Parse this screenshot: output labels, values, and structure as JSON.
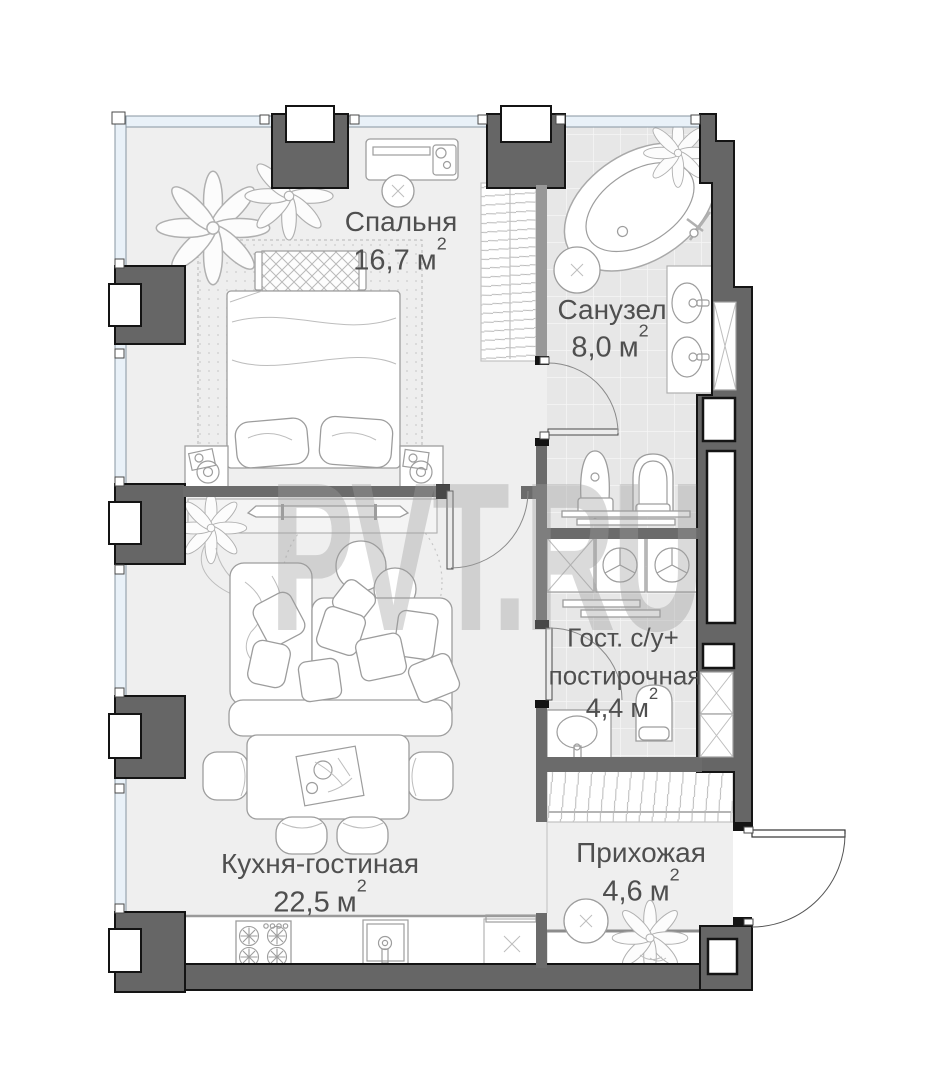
{
  "watermark": {
    "text": "PVT.RU"
  },
  "units": {
    "symbol": "м",
    "sup": "2"
  },
  "rooms": {
    "bedroom": {
      "name": "Спальня",
      "area": "16,7"
    },
    "bathroom": {
      "name": "Санузел",
      "area": "8,0"
    },
    "guest_wc": {
      "name_line1": "Гост. с/у+",
      "name_line2": "постирочная",
      "area": "4,4"
    },
    "kitchen_living": {
      "name": "Кухня-гостиная",
      "area": "22,5"
    },
    "hallway": {
      "name": "Прихожая",
      "area": "4,6"
    }
  },
  "fixtures": [
    "double-bed",
    "nightstand",
    "wardrobe",
    "bathtub",
    "double-sink-vanity",
    "toilet",
    "bidet",
    "washing-machine",
    "dryer",
    "laundry-sink",
    "sofa",
    "coffee-tables",
    "dining-table",
    "chairs",
    "kitchen-stove",
    "kitchen-sink",
    "refrigerator",
    "hallway-closet",
    "console",
    "entrance-door",
    "plants"
  ],
  "colors": {
    "wall": "#666666",
    "wall_outline": "#141414",
    "window_fill": "#e9f1f8",
    "tile_floor": "#e7e7e7",
    "floor": "#efefef",
    "label_text": "#4f4f4f",
    "watermark": "#9e9e9e"
  }
}
